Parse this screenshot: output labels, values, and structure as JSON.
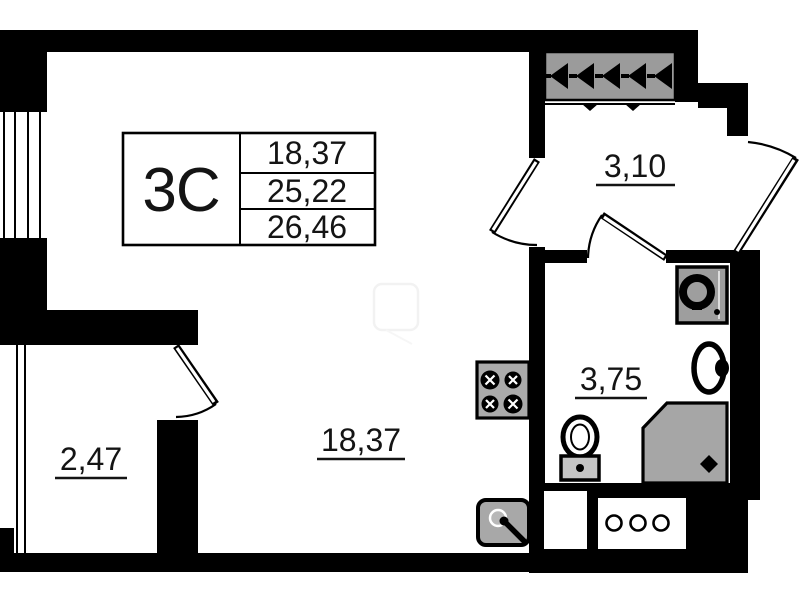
{
  "plan": {
    "unit": {
      "type_label": "3C",
      "spec_values": [
        "18,37",
        "25,22",
        "26,46"
      ]
    },
    "rooms": {
      "hallway": {
        "area": "3,10"
      },
      "bathroom": {
        "area": "3,75"
      },
      "living_room": {
        "area": "18,37"
      },
      "balcony": {
        "area": "2,47"
      }
    },
    "fixtures": [
      "ventilation-block",
      "stove",
      "kitchen-sink",
      "toilet",
      "washbasin",
      "washing-machine",
      "shower-tray",
      "utility-shaft"
    ],
    "colors": {
      "wall": "#000000",
      "fixture_gray": "#a6a6a6",
      "text": "#141414"
    }
  }
}
